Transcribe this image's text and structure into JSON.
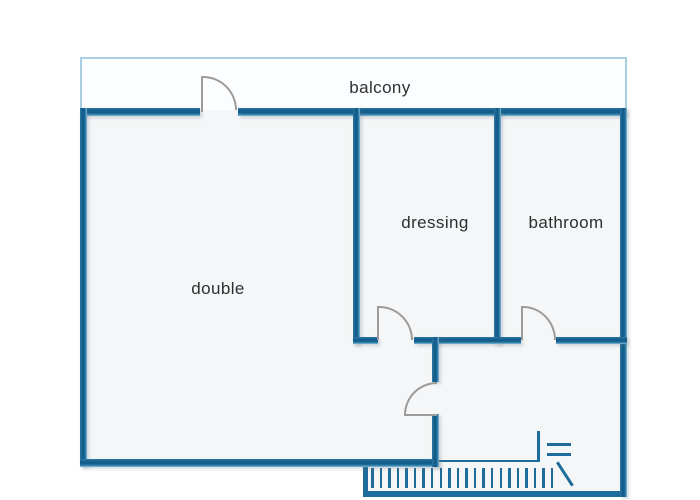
{
  "plan": {
    "type": "apartment-floor-plan"
  },
  "rooms": {
    "balcony": {
      "label": "balcony"
    },
    "double": {
      "label": "double"
    },
    "dressing": {
      "label": "dressing"
    },
    "bathroom": {
      "label": "bathroom"
    }
  },
  "symbols": {
    "doors": [
      "balcony-door",
      "dressing-door",
      "bathroom-door",
      "hall-door"
    ],
    "stairs": {
      "tread_count": 22,
      "tread_spacing_px": 8.57,
      "has_break_line": true
    }
  },
  "colors": {
    "wall": "#15618e",
    "room_fill": "#f5f6f7",
    "balcony_fill": "#fcfdfe",
    "balcony_border": "#a9cee2",
    "door": "#9b9b9b",
    "symbol": "#1d6c9b",
    "text": "#2d2f30",
    "background": "#ffffff"
  }
}
